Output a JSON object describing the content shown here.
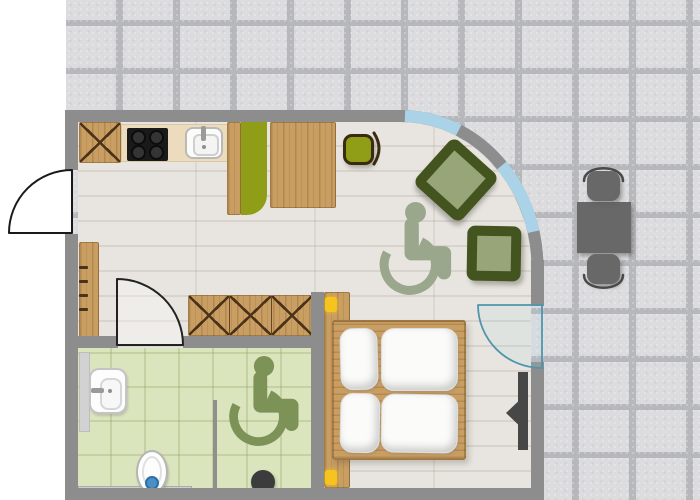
{
  "scene": {
    "type": "floor-plan",
    "name": "accessible-apartment-floor-plan"
  },
  "colors": {
    "wall": "#8d8d8d",
    "stone": "#dcdcde",
    "stone_joint": "#b7b8bb",
    "wood_floor": "#e8e5e0",
    "bath_floor": "#dae5be",
    "furniture_wood": "#c99e63",
    "wood_line": "#4a3318",
    "counter": "#ecdcbd",
    "stove": "#1a1a1a",
    "olive": "#8f9e16",
    "chair_dark_green": "#44541f",
    "chair_light_green": "#97a579",
    "wheelchair_living": "#9aa78d",
    "wheelchair_bath": "#7d9257",
    "window_blue": "#aad3e7",
    "glass_door": "#4e95ad",
    "lamp_yellow": "#f6c41e",
    "outdoor_gray": "#686868",
    "tv_dark": "#474747",
    "water_blue": "#4a8fc7"
  },
  "rooms": [
    {
      "name": "living-bedroom"
    },
    {
      "name": "bathroom"
    },
    {
      "name": "entry-corridor"
    },
    {
      "name": "terrace"
    }
  ],
  "objects": {
    "kitchen": [
      "x-front-cabinet",
      "stove-4-burners",
      "kitchen-sink",
      "kitchen-counter",
      "bar-counter-olive",
      "dining-table-wood",
      "bar-stool-olive"
    ],
    "living": [
      "armchair-rotated",
      "armchair",
      "wheelchair-accessibility-symbol",
      "curved-glazed-wall"
    ],
    "bedroom": [
      "double-bed",
      "headboard-panel",
      "reading-lamp",
      "reading-lamp",
      "wall-tv-panel",
      "wardrobe-x-front",
      "coat-rack"
    ],
    "bathroom": [
      "washbasin",
      "toilet",
      "shower-head",
      "shower-partition",
      "side-ledge",
      "bench",
      "wheelchair-accessibility-symbol"
    ],
    "terrace": [
      "outdoor-table",
      "outdoor-chair",
      "outdoor-chair"
    ],
    "doors": [
      "entrance-door",
      "bathroom-door",
      "terrace-glass-door"
    ]
  }
}
